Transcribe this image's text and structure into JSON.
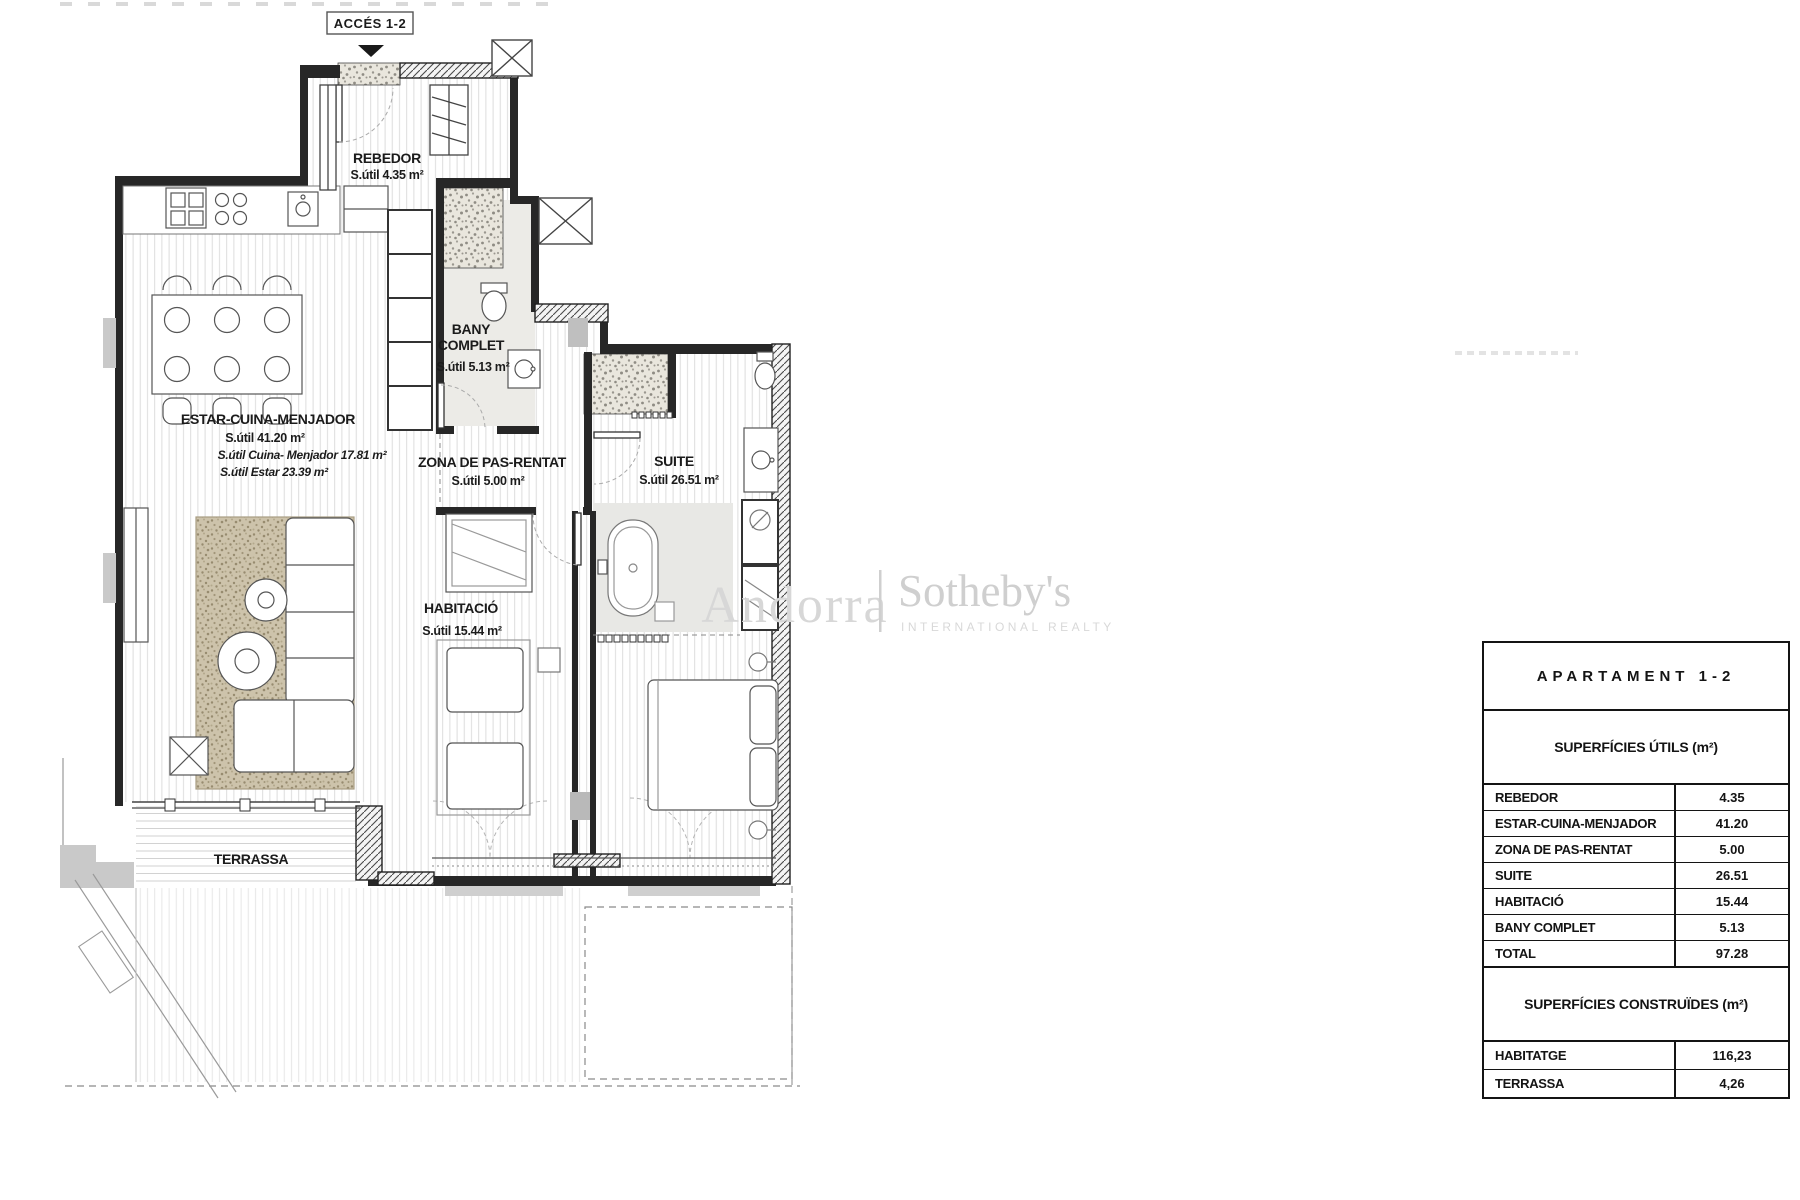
{
  "plan": {
    "access_label": "ACCÉS 1-2",
    "rooms": {
      "rebedor": {
        "name": "REBEDOR",
        "area": "S.útil 4.35 m²"
      },
      "estar": {
        "name": "ESTAR-CUINA-MENJADOR",
        "area": "S.útil 41.20 m²",
        "sub_cuina": "S.útil Cuina- Menjador 17.81 m²",
        "sub_estar": "S.útil Estar 23.39 m²"
      },
      "bany": {
        "name_line1": "BANY",
        "name_line2": "COMPLET",
        "area": "S.útil 5.13 m²"
      },
      "zona": {
        "name": "ZONA DE PAS-RENTAT",
        "area": "S.útil 5.00 m²"
      },
      "suite": {
        "name": "SUITE",
        "area": "S.útil 26.51 m²"
      },
      "habitacio": {
        "name": "HABITACIÓ",
        "area": "S.útil 15.44 m²"
      },
      "terrassa": {
        "name": "TERRASSA"
      }
    }
  },
  "watermark": {
    "brand_left": "Andorra",
    "brand_right": "Sotheby's",
    "tagline": "INTERNATIONAL REALTY"
  },
  "summary_table": {
    "title": "APARTAMENT 1-2",
    "utils_header": "SUPERFÍCIES ÚTILS (m²)",
    "utils_rows": [
      {
        "label": "REBEDOR",
        "value": "4.35"
      },
      {
        "label": "ESTAR-CUINA-MENJADOR",
        "value": "41.20"
      },
      {
        "label": "ZONA DE PAS-RENTAT",
        "value": "5.00"
      },
      {
        "label": "SUITE",
        "value": "26.51"
      },
      {
        "label": "HABITACIÓ",
        "value": "15.44"
      },
      {
        "label": "BANY COMPLET",
        "value": "5.13"
      },
      {
        "label": "TOTAL",
        "value": "97.28"
      }
    ],
    "constr_header": "SUPERFÍCIES CONSTRUÏDES  (m²)",
    "constr_rows": [
      {
        "label": "HABITATGE",
        "value": "116,23"
      },
      {
        "label": "TERRASSA",
        "value": "4,26"
      }
    ]
  },
  "colors": {
    "wall": "#272727",
    "watermark": "#d3d3d3",
    "rug": "#cdc3ab",
    "accent_gray": "#c9c9c9"
  }
}
